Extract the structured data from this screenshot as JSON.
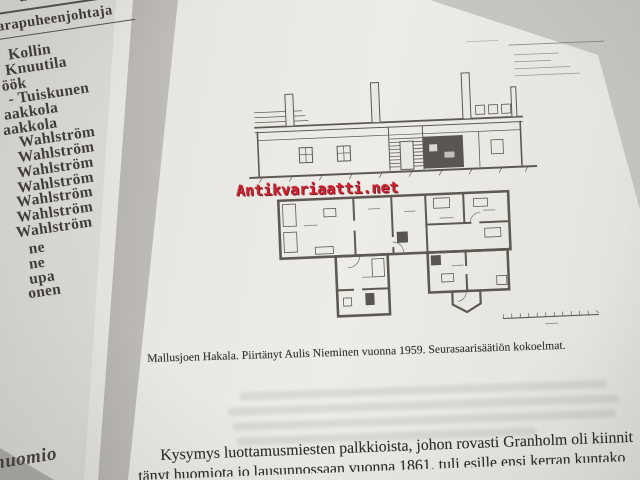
{
  "watermark": {
    "text": "Antikvariaatti.net",
    "color": "#cb2231"
  },
  "left_page": {
    "header_lines": [
      "uunta",
      "arapuheenjohtaja"
    ],
    "names": [
      "Kollin",
      "Knuutila",
      "öök",
      "- Tuiskunen",
      "aakkola",
      "aakkola",
      "Wahlström",
      "Wahlström",
      "Wahlström",
      "Wahlström",
      "Wahlström",
      "Wahlström",
      "Wahlström",
      "ne",
      "ne",
      "upa",
      "onen"
    ],
    "footer_word": "huomio"
  },
  "right_page": {
    "caption": "Mallusjoen Hakala. Piirtänyt Aulis Nieminen vuonna 1959. Seurasaarisäätiön kokoelmat.",
    "body_text": {
      "line1": "Kysymys luottamusmiesten palkkioista, johon rovasti Granholm oli kiinnit",
      "line2": "tänyt huomiota jo lausunnossaan vuonna 1861, tuli esille ensi kerran kuntako"
    }
  }
}
